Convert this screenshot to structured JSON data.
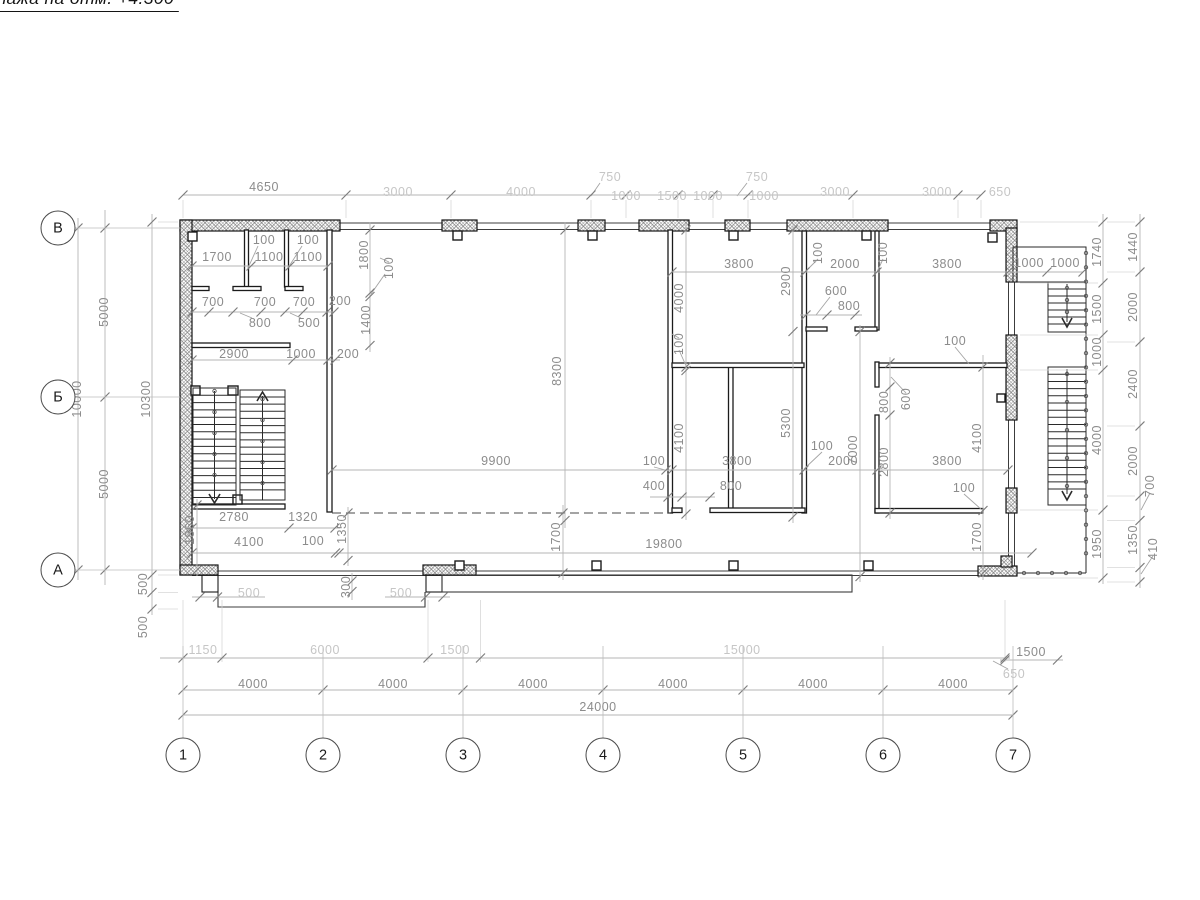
{
  "title": {
    "text": "Монтажный план этажа на отм. +4.300"
  },
  "axes": {
    "columns": [
      {
        "label": "1",
        "x": 183
      },
      {
        "label": "2",
        "x": 323
      },
      {
        "label": "3",
        "x": 463
      },
      {
        "label": "4",
        "x": 603
      },
      {
        "label": "5",
        "x": 743
      },
      {
        "label": "6",
        "x": 883
      },
      {
        "label": "7",
        "x": 1013
      }
    ],
    "columns_y": 755,
    "rows": [
      {
        "label": "В",
        "y": 228
      },
      {
        "label": "Б",
        "y": 397
      },
      {
        "label": "А",
        "y": 570
      }
    ],
    "rows_x": 58
  },
  "dimension_labels": [
    {
      "t": "4650",
      "x": 264,
      "y": 187
    },
    {
      "t": "3000",
      "x": 398,
      "y": 192,
      "l": 1
    },
    {
      "t": "4000",
      "x": 521,
      "y": 192,
      "l": 1
    },
    {
      "t": "750",
      "x": 610,
      "y": 177,
      "l": 1
    },
    {
      "t": "1000",
      "x": 626,
      "y": 196,
      "l": 1
    },
    {
      "t": "1500",
      "x": 672,
      "y": 196,
      "l": 1
    },
    {
      "t": "1000",
      "x": 708,
      "y": 196,
      "l": 1
    },
    {
      "t": "750",
      "x": 757,
      "y": 177,
      "l": 1
    },
    {
      "t": "1000",
      "x": 764,
      "y": 196,
      "l": 1
    },
    {
      "t": "3000",
      "x": 835,
      "y": 192,
      "l": 1
    },
    {
      "t": "3000",
      "x": 937,
      "y": 192,
      "l": 1
    },
    {
      "t": "650",
      "x": 1000,
      "y": 192,
      "l": 1
    },
    {
      "t": "100",
      "x": 264,
      "y": 240
    },
    {
      "t": "100",
      "x": 308,
      "y": 240
    },
    {
      "t": "1700",
      "x": 217,
      "y": 257
    },
    {
      "t": "1100",
      "x": 269,
      "y": 257
    },
    {
      "t": "1100",
      "x": 308,
      "y": 257
    },
    {
      "t": "1800",
      "x": 364,
      "y": 255,
      "v": 1
    },
    {
      "t": "100",
      "x": 389,
      "y": 268,
      "v": 1
    },
    {
      "t": "1400",
      "x": 366,
      "y": 320,
      "v": 1
    },
    {
      "t": "700",
      "x": 213,
      "y": 302
    },
    {
      "t": "700",
      "x": 265,
      "y": 302
    },
    {
      "t": "700",
      "x": 304,
      "y": 302
    },
    {
      "t": "200",
      "x": 340,
      "y": 301
    },
    {
      "t": "800",
      "x": 260,
      "y": 323
    },
    {
      "t": "500",
      "x": 309,
      "y": 323
    },
    {
      "t": "2900",
      "x": 234,
      "y": 354
    },
    {
      "t": "1000",
      "x": 301,
      "y": 354
    },
    {
      "t": "200",
      "x": 348,
      "y": 354
    },
    {
      "t": "2780",
      "x": 234,
      "y": 517
    },
    {
      "t": "1320",
      "x": 303,
      "y": 517
    },
    {
      "t": "1860",
      "x": 190,
      "y": 530,
      "v": 1
    },
    {
      "t": "1350",
      "x": 342,
      "y": 529,
      "v": 1
    },
    {
      "t": "4100",
      "x": 249,
      "y": 542
    },
    {
      "t": "100",
      "x": 313,
      "y": 541
    },
    {
      "t": "5000",
      "x": 104,
      "y": 312,
      "v": 1
    },
    {
      "t": "5000",
      "x": 104,
      "y": 484,
      "v": 1
    },
    {
      "t": "10000",
      "x": 77,
      "y": 399,
      "v": 1
    },
    {
      "t": "10300",
      "x": 146,
      "y": 399,
      "v": 1
    },
    {
      "t": "500",
      "x": 143,
      "y": 584,
      "v": 1
    },
    {
      "t": "500",
      "x": 143,
      "y": 627,
      "v": 1
    },
    {
      "t": "8300",
      "x": 557,
      "y": 371,
      "v": 1
    },
    {
      "t": "9900",
      "x": 496,
      "y": 461
    },
    {
      "t": "19800",
      "x": 664,
      "y": 544
    },
    {
      "t": "1700",
      "x": 556,
      "y": 537,
      "v": 1
    },
    {
      "t": "1700",
      "x": 977,
      "y": 537,
      "v": 1
    },
    {
      "t": "400",
      "x": 654,
      "y": 486
    },
    {
      "t": "800",
      "x": 731,
      "y": 486
    },
    {
      "t": "3800",
      "x": 739,
      "y": 264
    },
    {
      "t": "2000",
      "x": 845,
      "y": 264
    },
    {
      "t": "3800",
      "x": 947,
      "y": 264
    },
    {
      "t": "1000",
      "x": 1029,
      "y": 263
    },
    {
      "t": "1000",
      "x": 1065,
      "y": 263
    },
    {
      "t": "2900",
      "x": 786,
      "y": 281,
      "v": 1
    },
    {
      "t": "5300",
      "x": 786,
      "y": 423,
      "v": 1
    },
    {
      "t": "4000",
      "x": 679,
      "y": 298,
      "v": 1
    },
    {
      "t": "100",
      "x": 679,
      "y": 344,
      "v": 1
    },
    {
      "t": "4100",
      "x": 679,
      "y": 438,
      "v": 1
    },
    {
      "t": "100",
      "x": 654,
      "y": 461
    },
    {
      "t": "3800",
      "x": 737,
      "y": 461
    },
    {
      "t": "2000",
      "x": 843,
      "y": 461
    },
    {
      "t": "100",
      "x": 822,
      "y": 446
    },
    {
      "t": "3800",
      "x": 947,
      "y": 461
    },
    {
      "t": "100",
      "x": 964,
      "y": 488
    },
    {
      "t": "7000",
      "x": 853,
      "y": 450,
      "v": 1
    },
    {
      "t": "600",
      "x": 836,
      "y": 291
    },
    {
      "t": "800",
      "x": 849,
      "y": 306
    },
    {
      "t": "100",
      "x": 818,
      "y": 253,
      "v": 1
    },
    {
      "t": "100",
      "x": 883,
      "y": 253,
      "v": 1
    },
    {
      "t": "800",
      "x": 884,
      "y": 402,
      "v": 1
    },
    {
      "t": "600",
      "x": 906,
      "y": 399,
      "v": 1
    },
    {
      "t": "2800",
      "x": 884,
      "y": 462,
      "v": 1
    },
    {
      "t": "4100",
      "x": 977,
      "y": 438,
      "v": 1
    },
    {
      "t": "100",
      "x": 955,
      "y": 341
    },
    {
      "t": "1740",
      "x": 1097,
      "y": 252,
      "v": 1
    },
    {
      "t": "1500",
      "x": 1097,
      "y": 309,
      "v": 1
    },
    {
      "t": "1000",
      "x": 1097,
      "y": 352,
      "v": 1
    },
    {
      "t": "4000",
      "x": 1097,
      "y": 440,
      "v": 1
    },
    {
      "t": "1950",
      "x": 1097,
      "y": 544,
      "v": 1
    },
    {
      "t": "1440",
      "x": 1133,
      "y": 247,
      "v": 1
    },
    {
      "t": "2000",
      "x": 1133,
      "y": 307,
      "v": 1
    },
    {
      "t": "2400",
      "x": 1133,
      "y": 384,
      "v": 1
    },
    {
      "t": "2000",
      "x": 1133,
      "y": 461,
      "v": 1
    },
    {
      "t": "700",
      "x": 1150,
      "y": 486,
      "v": 1
    },
    {
      "t": "1350",
      "x": 1133,
      "y": 540,
      "v": 1
    },
    {
      "t": "410",
      "x": 1153,
      "y": 549,
      "v": 1
    },
    {
      "t": "500",
      "x": 249,
      "y": 593,
      "l": 1
    },
    {
      "t": "300",
      "x": 346,
      "y": 587,
      "v": 1
    },
    {
      "t": "500",
      "x": 401,
      "y": 593,
      "l": 1
    },
    {
      "t": "1150",
      "x": 203,
      "y": 650,
      "l": 1
    },
    {
      "t": "6000",
      "x": 325,
      "y": 650,
      "l": 1
    },
    {
      "t": "1500",
      "x": 455,
      "y": 650,
      "l": 1
    },
    {
      "t": "15000",
      "x": 742,
      "y": 650,
      "l": 1
    },
    {
      "t": "1500",
      "x": 1031,
      "y": 652
    },
    {
      "t": "650",
      "x": 1014,
      "y": 674,
      "l": 1
    },
    {
      "t": "4000",
      "x": 253,
      "y": 684
    },
    {
      "t": "4000",
      "x": 393,
      "y": 684
    },
    {
      "t": "4000",
      "x": 533,
      "y": 684
    },
    {
      "t": "4000",
      "x": 673,
      "y": 684
    },
    {
      "t": "4000",
      "x": 813,
      "y": 684
    },
    {
      "t": "4000",
      "x": 953,
      "y": 684
    },
    {
      "t": "24000",
      "x": 598,
      "y": 707
    }
  ]
}
